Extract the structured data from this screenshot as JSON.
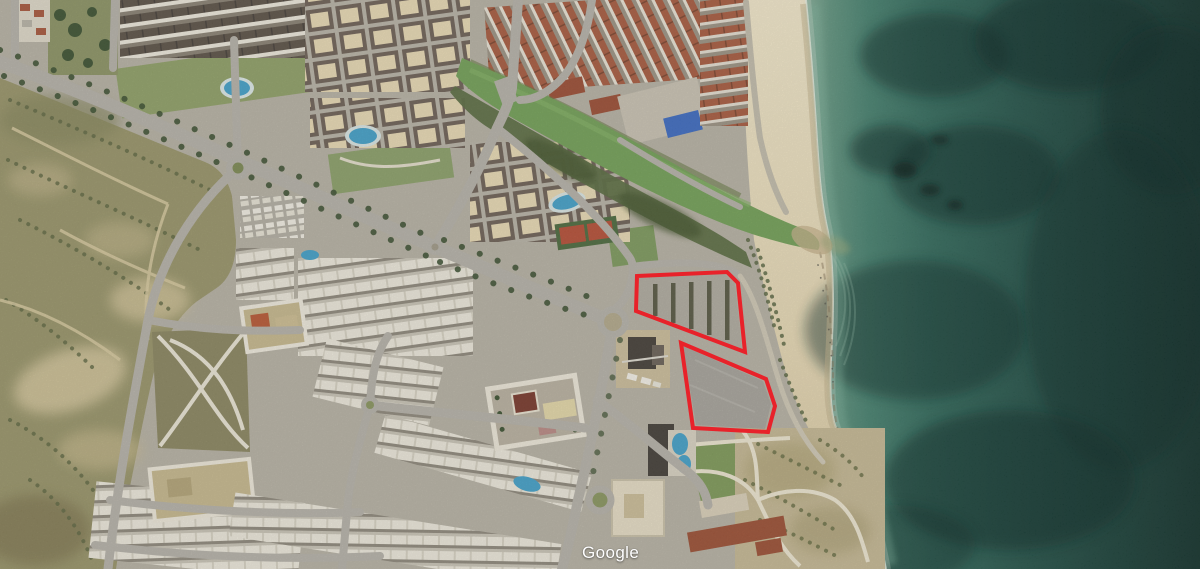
{
  "watermark": {
    "label": "Google"
  },
  "map": {
    "description": "Aerial satellite view of a coastal resort town: urban blocks and scrubland left, sandy beach and a green river outlet centre, teal sea right; two parcels outlined in red",
    "colors": {
      "annotation_red": "#e8222a",
      "sea_shallow": "#6fa08c",
      "sea_deep": "#16342e",
      "sand": "#eadfc0",
      "river_green": "#74a058",
      "scrub_olive": "#99956a",
      "urban_gray": "#b7b2a4",
      "road_gray": "#b6b2a9",
      "roof_terracotta": "#a85c40",
      "pool_blue": "#45a1c8",
      "lawn_green": "#8ca06a"
    },
    "annotations": {
      "parcel_upper": {
        "points": "637,276 727,272 738,283 745,352 636,311",
        "stroke_width": 4
      },
      "parcel_lower": {
        "points": "681,343 766,379 775,406 768,432 693,428",
        "stroke_width": 4
      }
    }
  }
}
